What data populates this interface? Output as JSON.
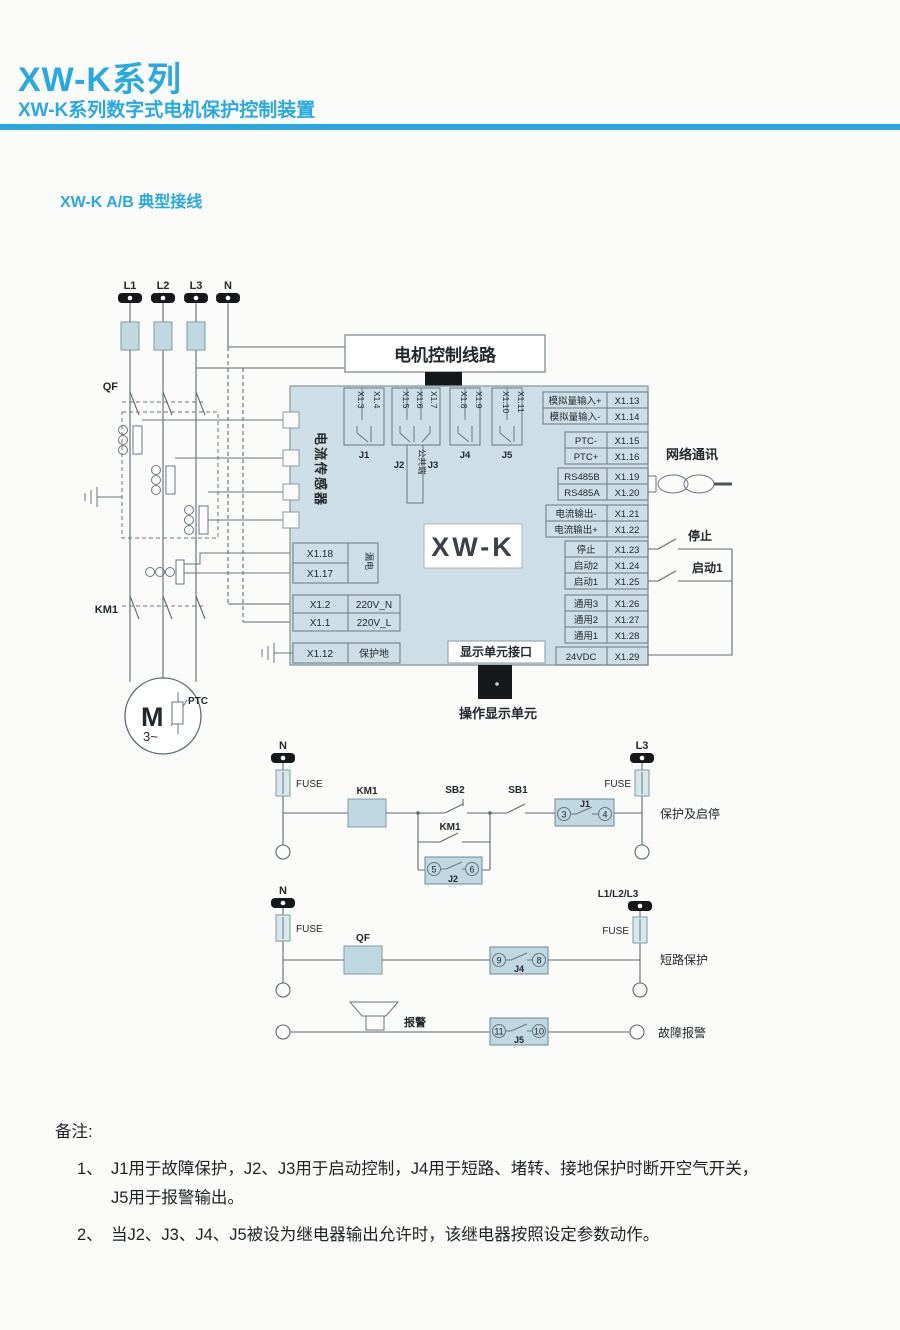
{
  "page": {
    "title": "XW-K系列",
    "subtitle": "XW-K系列数字式电机保护控制装置",
    "section_title": "XW-K A/B 典型接线",
    "accent": "#29a9e1"
  },
  "power": {
    "terminals": [
      "L1",
      "L2",
      "L3",
      "N"
    ],
    "qf": "QF",
    "km1": "KM1",
    "motor": "M",
    "motor_phase": "3~",
    "ptc": "PTC"
  },
  "device": {
    "name": "XW-K",
    "motor_control_box": "电机控制线路",
    "current_sensor": "电流传感器",
    "common_terminal": "公共端",
    "relay_groups": [
      {
        "label": "J1",
        "pins": [
          "X1.3",
          "X1.4"
        ]
      },
      {
        "label": "J2",
        "label2": "J3",
        "pins": [
          "X1.5",
          "X1.6",
          "X1.7"
        ]
      },
      {
        "label": "J4",
        "pins": [
          "X1.8",
          "X1.9"
        ]
      },
      {
        "label": "J5",
        "pins": [
          "X1.10",
          "X1.11"
        ]
      }
    ],
    "leakage_rows": [
      {
        "pin": "X1.18"
      },
      {
        "pin": "X1.17"
      }
    ],
    "leakage_label": "漏电",
    "power_rows": [
      {
        "pin": "X1.2",
        "label": "220V_N"
      },
      {
        "pin": "X1.1",
        "label": "220V_L"
      }
    ],
    "pe_row": {
      "pin": "X1.12",
      "label": "保护地"
    },
    "right_groups": [
      {
        "rows": [
          {
            "label": "模拟量输入+",
            "pin": "X1.13"
          },
          {
            "label": "模拟量输入-",
            "pin": "X1.14"
          }
        ]
      },
      {
        "rows": [
          {
            "label": "PTC-",
            "pin": "X1.15"
          },
          {
            "label": "PTC+",
            "pin": "X1.16"
          }
        ]
      },
      {
        "rows": [
          {
            "label": "RS485B",
            "pin": "X1.19"
          },
          {
            "label": "RS485A",
            "pin": "X1.20"
          }
        ]
      },
      {
        "rows": [
          {
            "label": "电流输出-",
            "pin": "X1.21"
          },
          {
            "label": "电流输出+",
            "pin": "X1.22"
          }
        ]
      },
      {
        "rows": [
          {
            "label": "停止",
            "pin": "X1.23"
          },
          {
            "label": "启动2",
            "pin": "X1.24"
          },
          {
            "label": "启动1",
            "pin": "X1.25"
          }
        ]
      },
      {
        "rows": [
          {
            "label": "通用3",
            "pin": "X1.26"
          },
          {
            "label": "通用2",
            "pin": "X1.27"
          },
          {
            "label": "通用1",
            "pin": "X1.28"
          }
        ]
      },
      {
        "rows": [
          {
            "label": "24VDC",
            "pin": "X1.29"
          }
        ]
      }
    ],
    "display_interface": "显示单元接口",
    "display_unit": "操作显示单元",
    "network": "网络通讯",
    "stop_switch": "停止",
    "start_switch": "启动1"
  },
  "circuits": {
    "c1": {
      "left_terminal": "N",
      "fuse_left": "FUSE",
      "km1": "KM1",
      "sb2": "SB2",
      "km1_aux": "KM1",
      "j2": "J2",
      "j2_t1": "5",
      "j2_t2": "6",
      "sb1": "SB1",
      "j1": "J1",
      "j1_t1": "3",
      "j1_t2": "4",
      "fuse_right": "FUSE",
      "right_terminal": "L3",
      "caption": "保护及启停"
    },
    "c2": {
      "left_terminal": "N",
      "fuse_left": "FUSE",
      "qf": "QF",
      "j4": "J4",
      "j4_t1": "9",
      "j4_t2": "8",
      "fuse_right": "FUSE",
      "right_terminal": "L1/L2/L3",
      "caption": "短路保护"
    },
    "c3": {
      "alarm": "报警",
      "j5": "J5",
      "j5_t1": "11",
      "j5_t2": "10",
      "caption": "故障报警"
    }
  },
  "notes": {
    "heading": "备注:",
    "item1_no": "1、",
    "item1_line1": "J1用于故障保护，J2、J3用于启动控制，J4用于短路、堵转、接地保护时断开空气开关，",
    "item1_line2": "J5用于报警输出。",
    "item2_no": "2、",
    "item2": "当J2、J3、J4、J5被设为继电器输出允许时，该继电器按照设定参数动作。"
  }
}
